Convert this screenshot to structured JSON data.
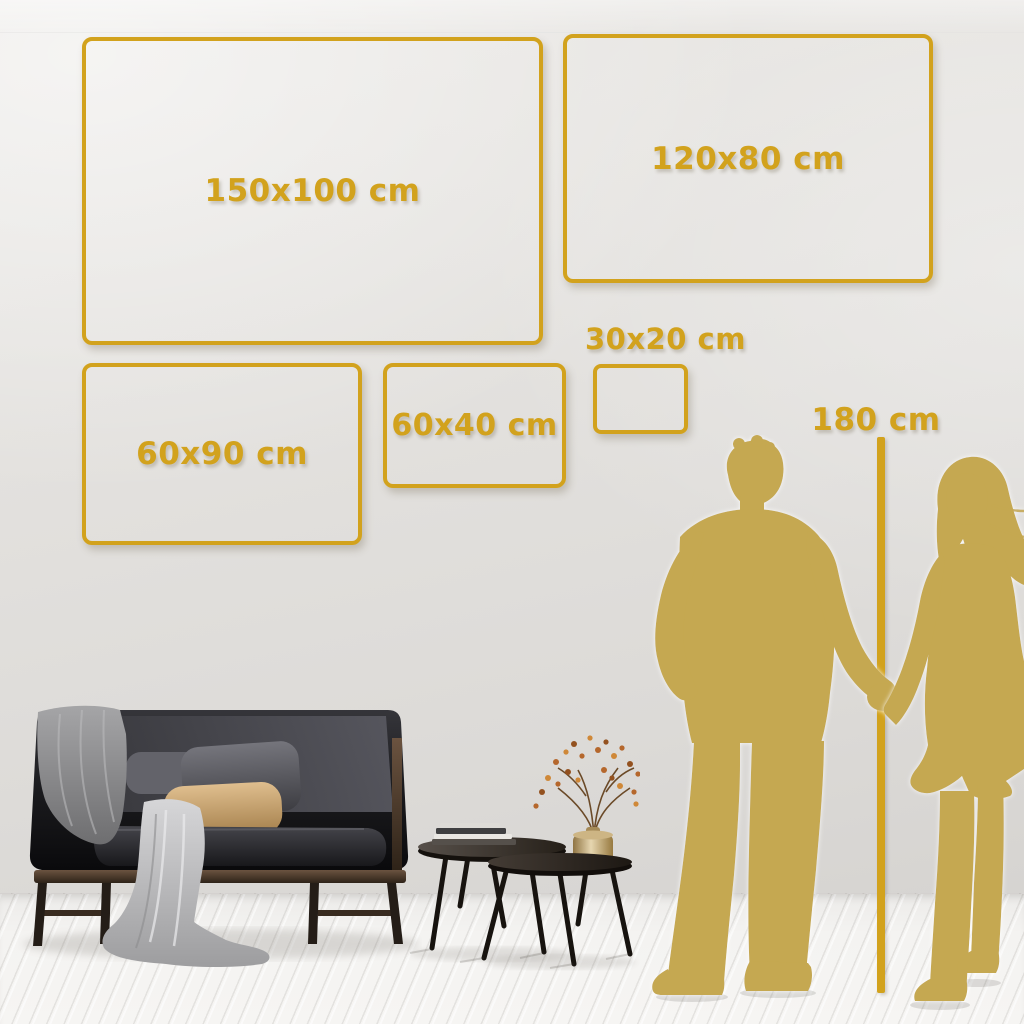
{
  "frames": [
    {
      "id": "150x100",
      "label": "150x100 cm",
      "width_cm": 150,
      "height_cm": 100
    },
    {
      "id": "120x80",
      "label": "120x80 cm",
      "width_cm": 120,
      "height_cm": 80
    },
    {
      "id": "60x90",
      "label": "60x90 cm",
      "width_cm": 60,
      "height_cm": 90
    },
    {
      "id": "60x40",
      "label": "60x40 cm",
      "width_cm": 60,
      "height_cm": 40
    },
    {
      "id": "30x20",
      "label": "30x20 cm",
      "width_cm": 30,
      "height_cm": 20
    }
  ],
  "reference": {
    "height_label": "180 cm",
    "height_cm": 180
  },
  "colors": {
    "gold": "#d2a21d",
    "silhouette": "#c5a851",
    "wall": "#e4e2df",
    "floor": "#f4f3f1"
  },
  "scene_objects": [
    "man-silhouette",
    "woman-silhouette",
    "height-ruler-line",
    "dark-velvet-sofa",
    "gray-blanket",
    "tan-pillow",
    "nesting-coffee-tables",
    "books-stack",
    "brass-vase-with-dried-branch",
    "white-plank-floor"
  ]
}
